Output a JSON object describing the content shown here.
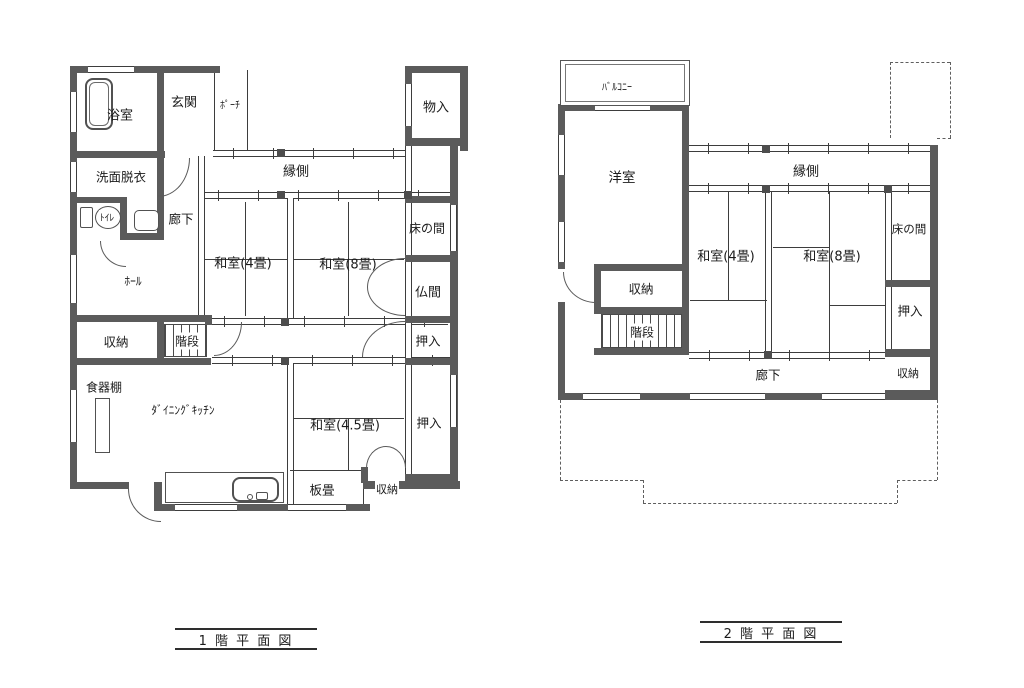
{
  "colors": {
    "wall": "#5b5b5b",
    "line": "#3d3d3d",
    "background": "#ffffff"
  },
  "floor1": {
    "title": "1 階 平 面 図",
    "rooms": {
      "bath": "浴室",
      "entry": "玄関",
      "porch": "ﾎﾟｰﾁ",
      "storage_top": "物入",
      "washroom": "洗面脱衣",
      "toilet": "ﾄｲﾚ",
      "corridor": "廊下",
      "engawa": "縁側",
      "tokonoma": "床の間",
      "washitsu4": "和室(4畳)",
      "washitsu8": "和室(8畳)",
      "butsuma": "仏間",
      "hall": "ﾎｰﾙ",
      "oshiire_mid": "押入",
      "shuno_hall": "収納",
      "stairs": "階段",
      "cupboard": "食器棚",
      "dining_kitchen": "ﾀﾞｲﾆﾝｸﾞｷｯﾁﾝ",
      "washitsu45": "和室(4.5畳)",
      "oshiire_low": "押入",
      "itajiki": "板畳",
      "shuno_bottom": "収納"
    }
  },
  "floor2": {
    "title": "2 階 平 面 図",
    "rooms": {
      "balcony": "ﾊﾞﾙｺﾆｰ",
      "yoshitsu": "洋室",
      "engawa": "縁側",
      "washitsu4": "和室(4畳)",
      "washitsu8": "和室(8畳)",
      "tokonoma": "床の間",
      "oshiire": "押入",
      "shuno_left": "収納",
      "stairs": "階段",
      "corridor": "廊下",
      "shuno_right": "収納"
    }
  }
}
